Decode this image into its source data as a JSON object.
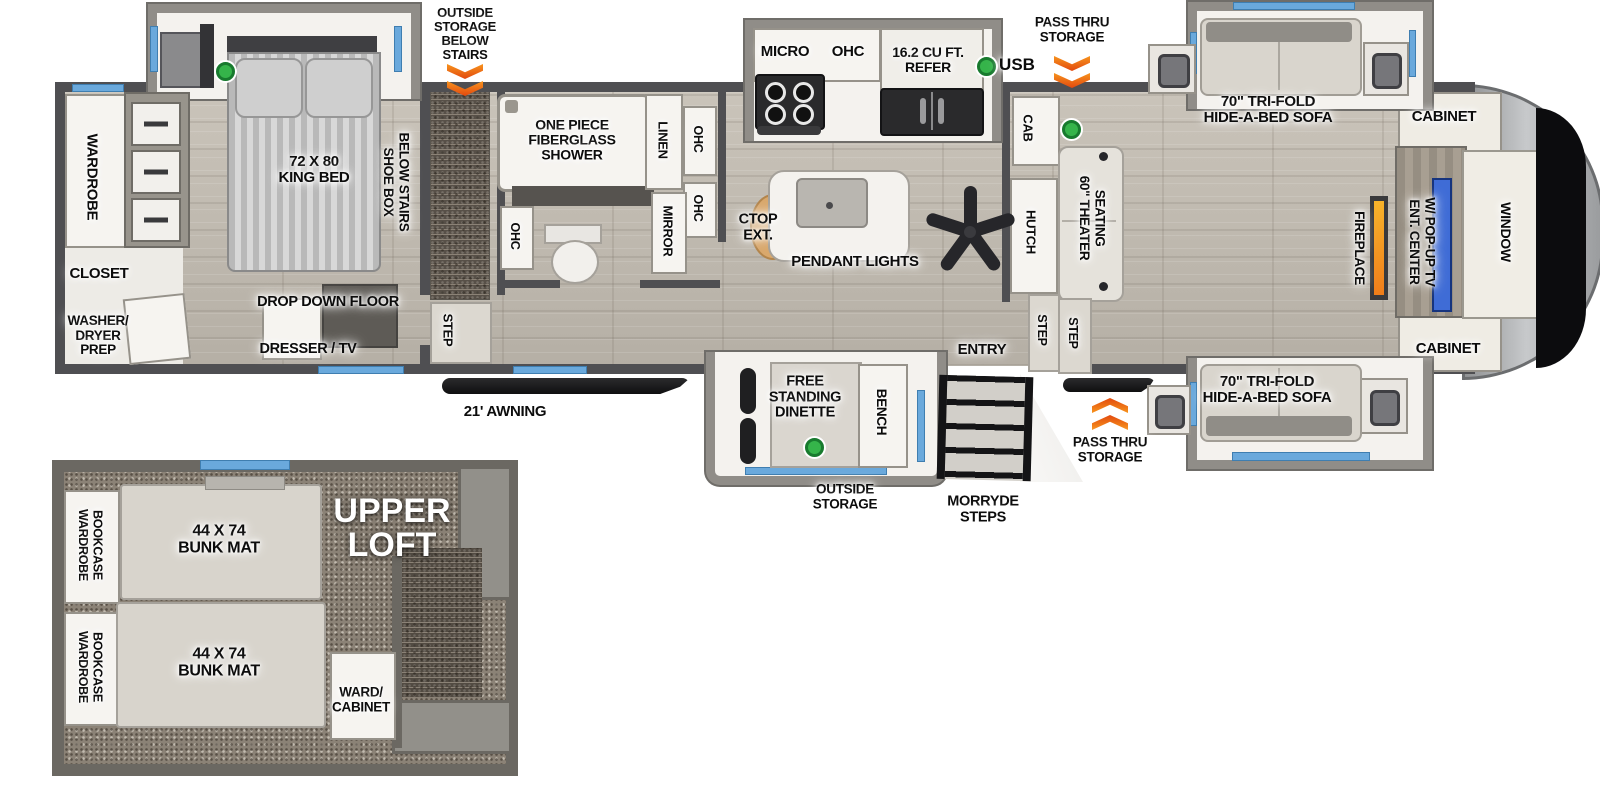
{
  "legend": {
    "usb": "USB"
  },
  "callouts": {
    "outside_storage_below_stairs": "OUTSIDE\nSTORAGE\nBELOW\nSTAIRS",
    "pass_thru_storage": "PASS THRU\nSTORAGE",
    "outside_storage": "OUTSIDE\nSTORAGE",
    "morryde_steps": "MORRYDE\nSTEPS",
    "awning": "21' AWNING",
    "entry": "ENTRY"
  },
  "bedroom": {
    "wardrobe": "WARDROBE",
    "king_bed": "72 X 80\nKING BED",
    "shoe_box": "SHOE BOX\nBELOW STAIRS",
    "closet": "CLOSET",
    "washer_dryer_prep": "WASHER/\nDRYER\nPREP",
    "drop_down_floor": "DROP DOWN FLOOR",
    "dresser_tv": "DRESSER / TV",
    "step": "STEP"
  },
  "bathroom": {
    "shower": "ONE PIECE\nFIBERGLASS\nSHOWER",
    "linen": "LINEN",
    "ohc": "OHC",
    "mirror": "MIRROR"
  },
  "kitchen": {
    "micro": "MICRO",
    "ohc": "OHC",
    "refer": "16.2 CU FT.\nREFER",
    "ctop_ext": "CTOP\nEXT.",
    "pendant_lights": "PENDANT LIGHTS",
    "cab": "CAB",
    "hutch": "HUTCH"
  },
  "living": {
    "theater_seating": "60\" THEATER\nSEATING",
    "trifold_sofa": "70\" TRI-FOLD\nHIDE-A-BED SOFA",
    "cabinet": "CABINET",
    "fireplace": "FIREPLACE",
    "ent_center": "ENT. CENTER\nW/ POP-UP TV",
    "window": "WINDOW",
    "step": "STEP"
  },
  "dinette": {
    "free_standing_dinette": "FREE\nSTANDING\nDINETTE",
    "bench": "BENCH"
  },
  "loft": {
    "upper_loft": "UPPER\nLOFT",
    "bunk_mat": "44 X 74\nBUNK MAT",
    "wardrobe_bookcase": "WARDROBE\nBOOKCASE",
    "ward_cabinet": "WARD/\nCABINET"
  },
  "colors": {
    "window_blue": "#6aa9dc",
    "arrow_orange": "#f26522",
    "usb_green": "#35b44a",
    "fireplace_orange": "#f59a23",
    "tv_blue": "#3f6cd6"
  }
}
